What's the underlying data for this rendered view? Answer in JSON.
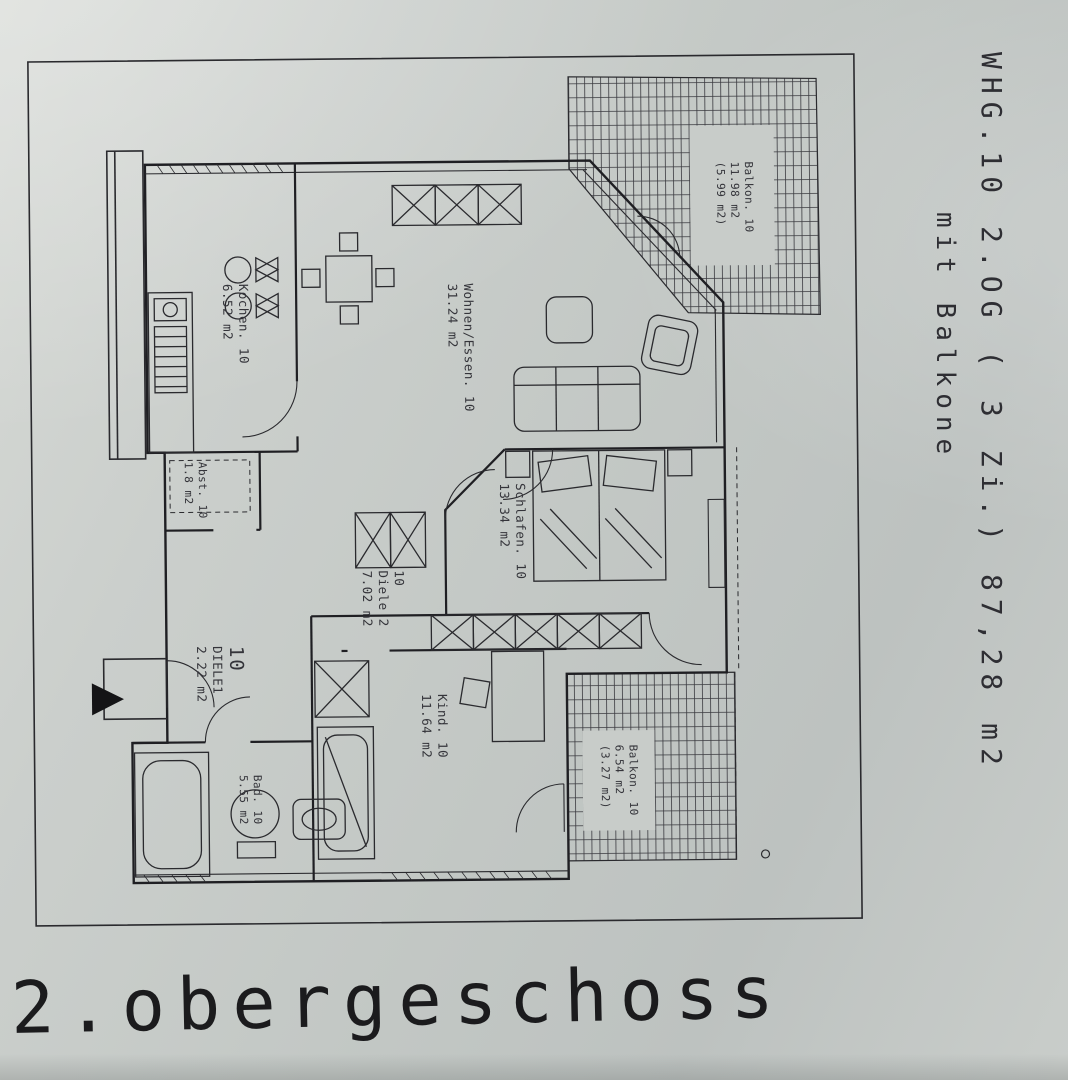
{
  "colors": {
    "ink": "#26262b",
    "paper": "#c8ccc9"
  },
  "plan": {
    "sheet_title": "2.obergeschoss",
    "side_text_primary": "WHG.10  2.OG  ( 3 Zi.)    87,28 m2",
    "side_text_secondary": "mit Balkone",
    "rooms": {
      "balkon_top": {
        "lines": [
          "Balkon. 10",
          "11.98 m2",
          "(5.99 m2)"
        ]
      },
      "kochen": {
        "lines": [
          "Kochen. 10",
          "6.52 m2"
        ]
      },
      "wohnen": {
        "lines": [
          "Wohnen/Essen. 10",
          "31.24 m2"
        ]
      },
      "schlafen": {
        "lines": [
          "Schlafen. 10",
          "13.34 m2"
        ]
      },
      "abst": {
        "lines": [
          "Abst. 10",
          "1.8 m2"
        ]
      },
      "diele2": {
        "lines": [
          "10",
          "Diele 2",
          "7.02 m2"
        ]
      },
      "diele1": {
        "lines": [
          "10",
          "DIELE1",
          "2.22 m2"
        ]
      },
      "bad": {
        "lines": [
          "Bad. 10",
          "5.55 m2"
        ]
      },
      "kind": {
        "lines": [
          "Kind. 10",
          "11.64 m2"
        ]
      },
      "balkon_bottom": {
        "lines": [
          "Balkon. 10",
          "6.54 m2",
          "(3.27 m2)"
        ]
      }
    }
  }
}
